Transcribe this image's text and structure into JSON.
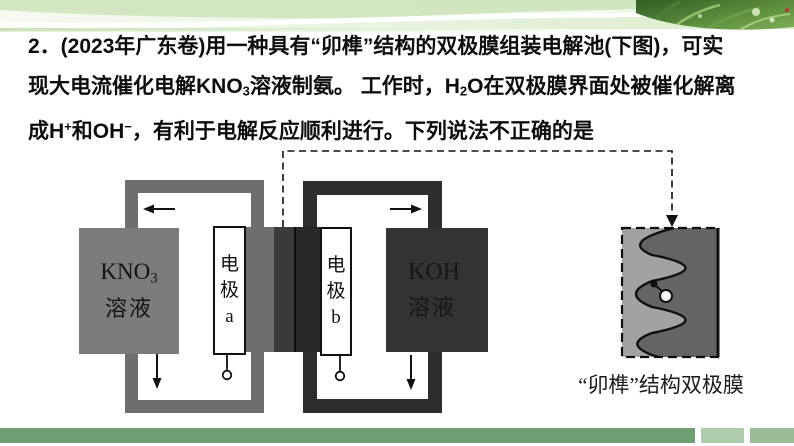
{
  "slide": {
    "question": {
      "lines": [
        {
          "segments": [
            {
              "t": "2．(2023年广东卷)用一种具有“卯榫”结构的双极膜组装电解池(下图)，可实"
            }
          ]
        },
        {
          "segments": [
            {
              "t": "现大电流催化电解KNO"
            },
            {
              "t": "3",
              "s": "sub"
            },
            {
              "t": "溶液制氨。 工作时，H"
            },
            {
              "t": "2",
              "s": "sub"
            },
            {
              "t": "O在双极膜界面处被催化解离"
            }
          ]
        },
        {
          "segments": [
            {
              "t": "成H"
            },
            {
              "t": "+",
              "s": "sup"
            },
            {
              "t": "和OH"
            },
            {
              "t": "−",
              "s": "sup"
            },
            {
              "t": "，有利于电解反应顺利进行。下列说法不正确的是"
            }
          ]
        }
      ]
    },
    "diagram": {
      "left_cell": {
        "solution_line1": [
          {
            "t": "KNO"
          },
          {
            "t": "3",
            "s": "sub"
          }
        ],
        "solution_line2": "溶液",
        "electrode_label": "电极a",
        "top_flow_arrow": "left",
        "bottom_flow_arrow": "down"
      },
      "right_cell": {
        "solution_line1": "KOH",
        "solution_line2": "溶液",
        "electrode_label": "电极b",
        "top_flow_arrow": "right",
        "bottom_flow_arrow": "down"
      },
      "membrane_detail_caption": "“卯榫”结构双极膜"
    },
    "colors": {
      "loop_gray": "#6e6e6e",
      "loop_dark": "#2d2d2d",
      "solution_gray": "#7c7c7c",
      "solution_dark": "#333333",
      "membrane_mid": "#3a3a3a",
      "membrane_detail_light": "#a2a2a2",
      "membrane_detail_dark": "#646464",
      "banner_green": "#cde4ba",
      "footer_bar_green": "#6f9e72",
      "footer_square_light": "#aecbac",
      "footer_square_mid": "#9bbc99"
    }
  }
}
